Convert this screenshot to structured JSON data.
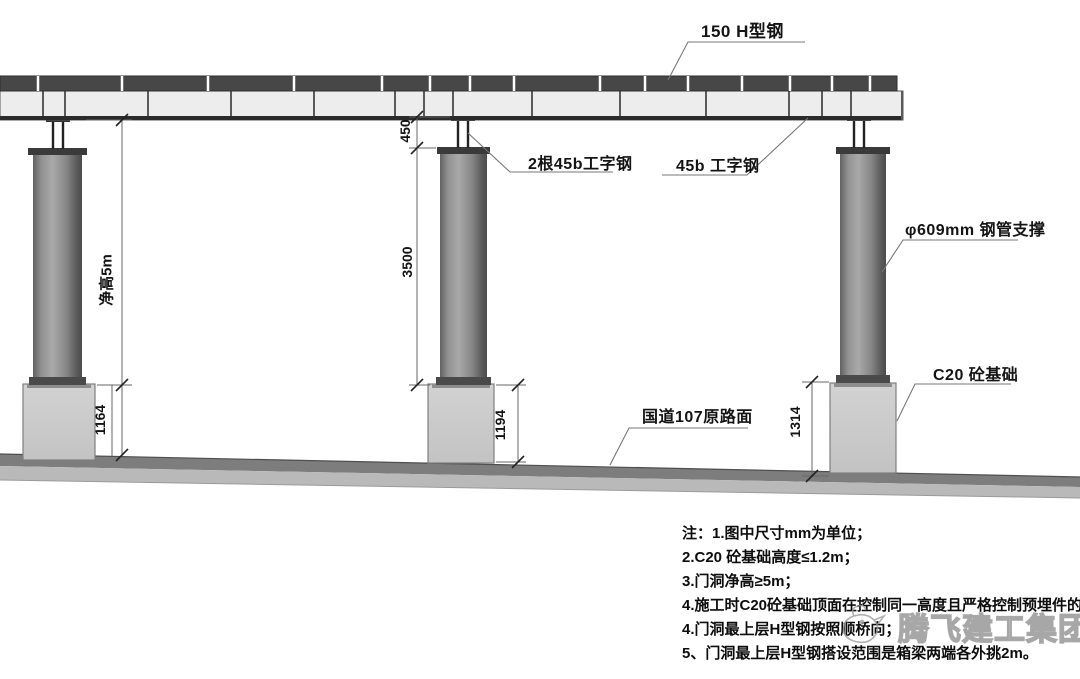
{
  "labels": {
    "h_steel": "150 H型钢",
    "double_i_beam": "2根45b工字钢",
    "i_beam": "45b 工字钢",
    "pipe_support": "φ609mm 钢管支撑",
    "foundation": "C20 砼基础",
    "road": "国道107原路面"
  },
  "dimensions": {
    "clear_height": "净高5m",
    "jack_height": "450",
    "column_height": "3500",
    "foundation_left": "1164",
    "foundation_center": "1194",
    "foundation_right": "1314"
  },
  "notes": {
    "lines": [
      "注：1.图中尺寸mm为单位；",
      "2.C20 砼基础高度≤1.2m；",
      "3.门洞净高≥5m；",
      "4.施工时C20砼基础顶面在控制同一高度且严格控制预埋件的位置；",
      "4.门洞最上层H型钢按照顺桥向；",
      "5、门洞最上层H型钢搭设范围是箱梁两端各外挑2m。"
    ]
  },
  "watermark": {
    "text": "腾飞建工集团"
  },
  "colors": {
    "top_beam": "#474747",
    "deck_beam": "#ededed",
    "column": "#8a8a8a",
    "foundation": "#cacaca",
    "ground_dark": "#7d7d7d",
    "ground_light": "#b9b9b9"
  }
}
